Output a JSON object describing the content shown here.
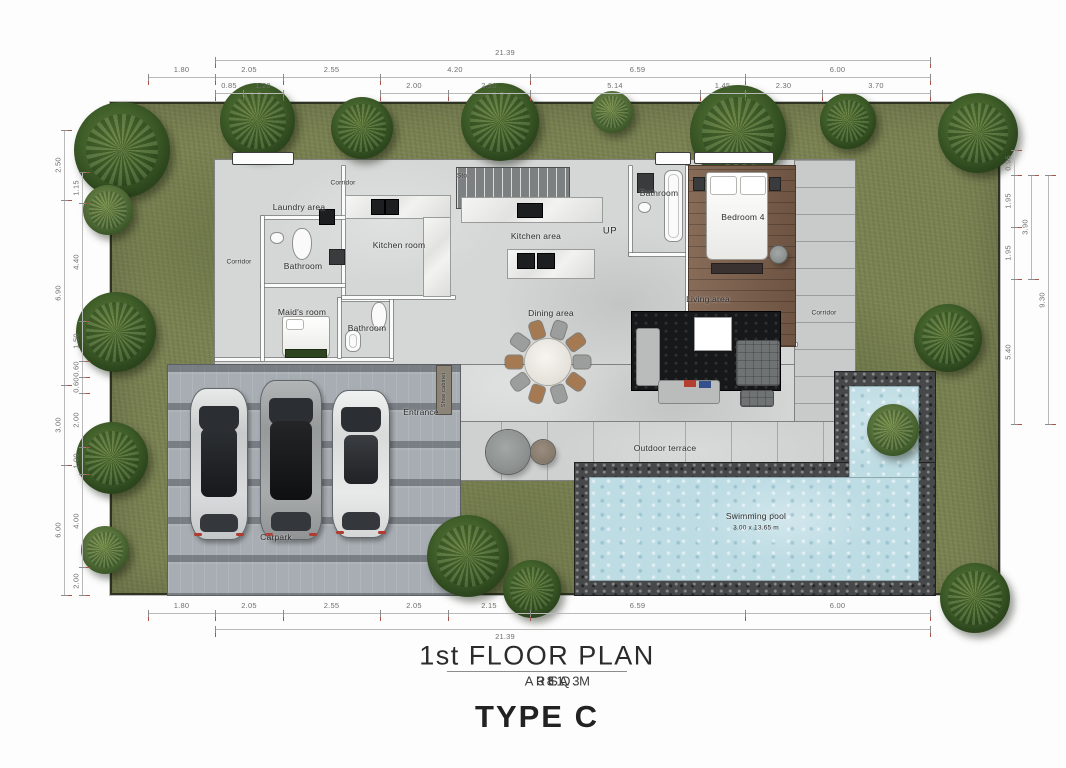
{
  "title_block": {
    "floor_title": "1st FLOOR PLAN",
    "area_label": "AREA",
    "area_value": "381.3",
    "area_unit": "SQ.M",
    "type_label": "TYPE C"
  },
  "rooms": {
    "corridor_top": "Corridor",
    "laundry": "Laundry area",
    "bathroom_1": "Bathroom",
    "kitchen_room": "Kitchen room",
    "corridor_left": "Corridor",
    "maids_room": "Maid's room",
    "bathroom_2": "Bathroom",
    "storage": "Sto.",
    "kitchen_area": "Kitchen area",
    "stairs_up": "UP",
    "bathroom_3": "Bathroom",
    "bedroom_4": "Bedroom 4",
    "living_area": "Living area",
    "corridor_right": "Corridor",
    "dining_area": "Dining area",
    "entrance": "Entrance",
    "shoe_cabinet": "Shoe cabinet",
    "outdoor_terrace": "Outdoor terrace",
    "swimming_pool": "Swimming pool",
    "swimming_pool_size": "3.00 x 13.65 m",
    "carpark": "Carpark"
  },
  "dimensions": {
    "top_total": [
      "21.39"
    ],
    "top_row": [
      "1.80",
      "2.05",
      "2.55",
      "4.20",
      "6.59",
      "6.00"
    ],
    "top_sub": [
      "0.85",
      "1.20",
      "2.00",
      "2.20",
      "5.14",
      "1.45",
      "2.30",
      "3.70"
    ],
    "bottom_row": [
      "1.80",
      "2.05",
      "2.55",
      "2.05",
      "2.15",
      "6.59",
      "6.00"
    ],
    "bottom_total": [
      "21.39"
    ],
    "left_outer": [
      "2.50",
      "6.90",
      "3.00",
      "6.00"
    ],
    "left_inner": [
      "1.15",
      "4.40",
      "1.50",
      "0.60",
      "0.60",
      "2.00",
      "1.00",
      "4.00",
      "2.00"
    ],
    "right_inner": [
      "0.95",
      "1.95",
      "1.95",
      "5.40"
    ],
    "right_mid": [
      "3.90"
    ],
    "right_outer": [
      "9.30"
    ]
  },
  "colors": {
    "grass": "#7a8252",
    "floor": "#d5d7d6",
    "pool_water": "#bedce4",
    "pool_deck": "#46484a",
    "paver": "#a7adb2",
    "wood_floor": "#7d5f4b",
    "tick_accent": "#a8564a"
  }
}
